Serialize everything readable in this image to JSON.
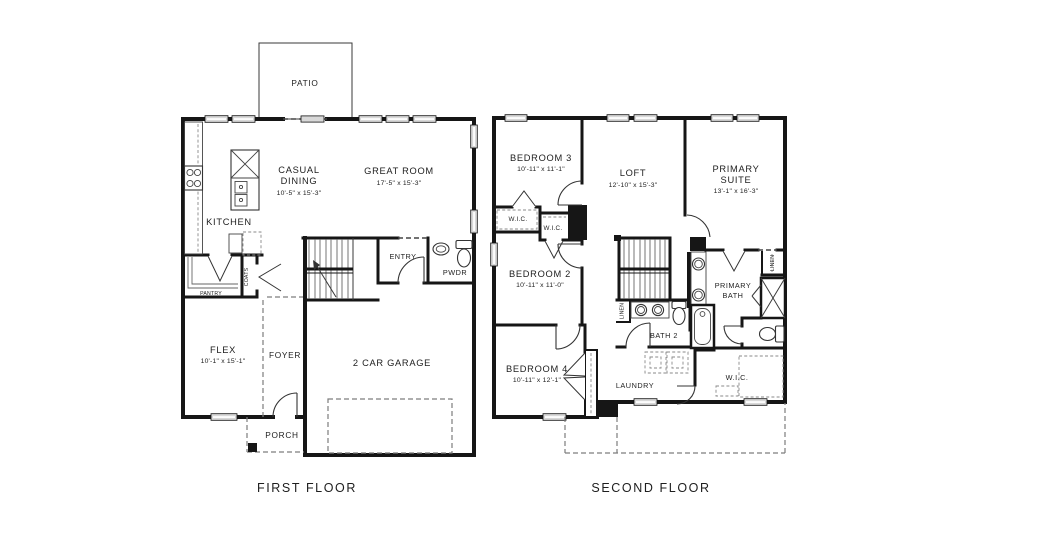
{
  "first_floor": {
    "title": "FIRST FLOOR",
    "rooms": {
      "patio": {
        "name": "PATIO"
      },
      "casual_dining": {
        "line1": "CASUAL",
        "line2": "DINING",
        "dims": "10'-5\" x 15'-3\""
      },
      "great_room": {
        "name": "GREAT ROOM",
        "dims": "17'-5\" x 15'-3\""
      },
      "kitchen": {
        "name": "KITCHEN"
      },
      "pantry": {
        "name": "PANTRY"
      },
      "coats": {
        "name": "COATS"
      },
      "entry": {
        "name": "ENTRY"
      },
      "powder": {
        "name": "PWDR"
      },
      "flex": {
        "name": "FLEX",
        "dims": "10'-1\" x 15'-1\""
      },
      "foyer": {
        "name": "FOYER"
      },
      "garage": {
        "name": "2 CAR GARAGE"
      },
      "porch": {
        "name": "PORCH"
      }
    }
  },
  "second_floor": {
    "title": "SECOND FLOOR",
    "rooms": {
      "bedroom3": {
        "name": "BEDROOM 3",
        "dims": "10'-11\" x 11'-1\""
      },
      "loft": {
        "name": "LOFT",
        "dims": "12'-10\" x 15'-3\""
      },
      "primary_suite": {
        "line1": "PRIMARY",
        "line2": "SUITE",
        "dims": "13'-1\" x 16'-3\""
      },
      "wic_bed3_a": {
        "name": "W.I.C."
      },
      "wic_bed3_b": {
        "name": "W.I.C."
      },
      "bedroom2": {
        "name": "BEDROOM 2",
        "dims": "10'-11\" x 11'-0\""
      },
      "primary_bath": {
        "line1": "PRIMARY",
        "line2": "BATH"
      },
      "linen_a": {
        "name": "LINEN"
      },
      "linen_b": {
        "name": "LINEN"
      },
      "bath2": {
        "name": "BATH 2"
      },
      "bedroom4": {
        "name": "BEDROOM 4",
        "dims": "10'-11\" x 12'-1\""
      },
      "laundry": {
        "name": "LAUNDRY"
      },
      "wic_primary": {
        "name": "W.I.C."
      }
    }
  }
}
